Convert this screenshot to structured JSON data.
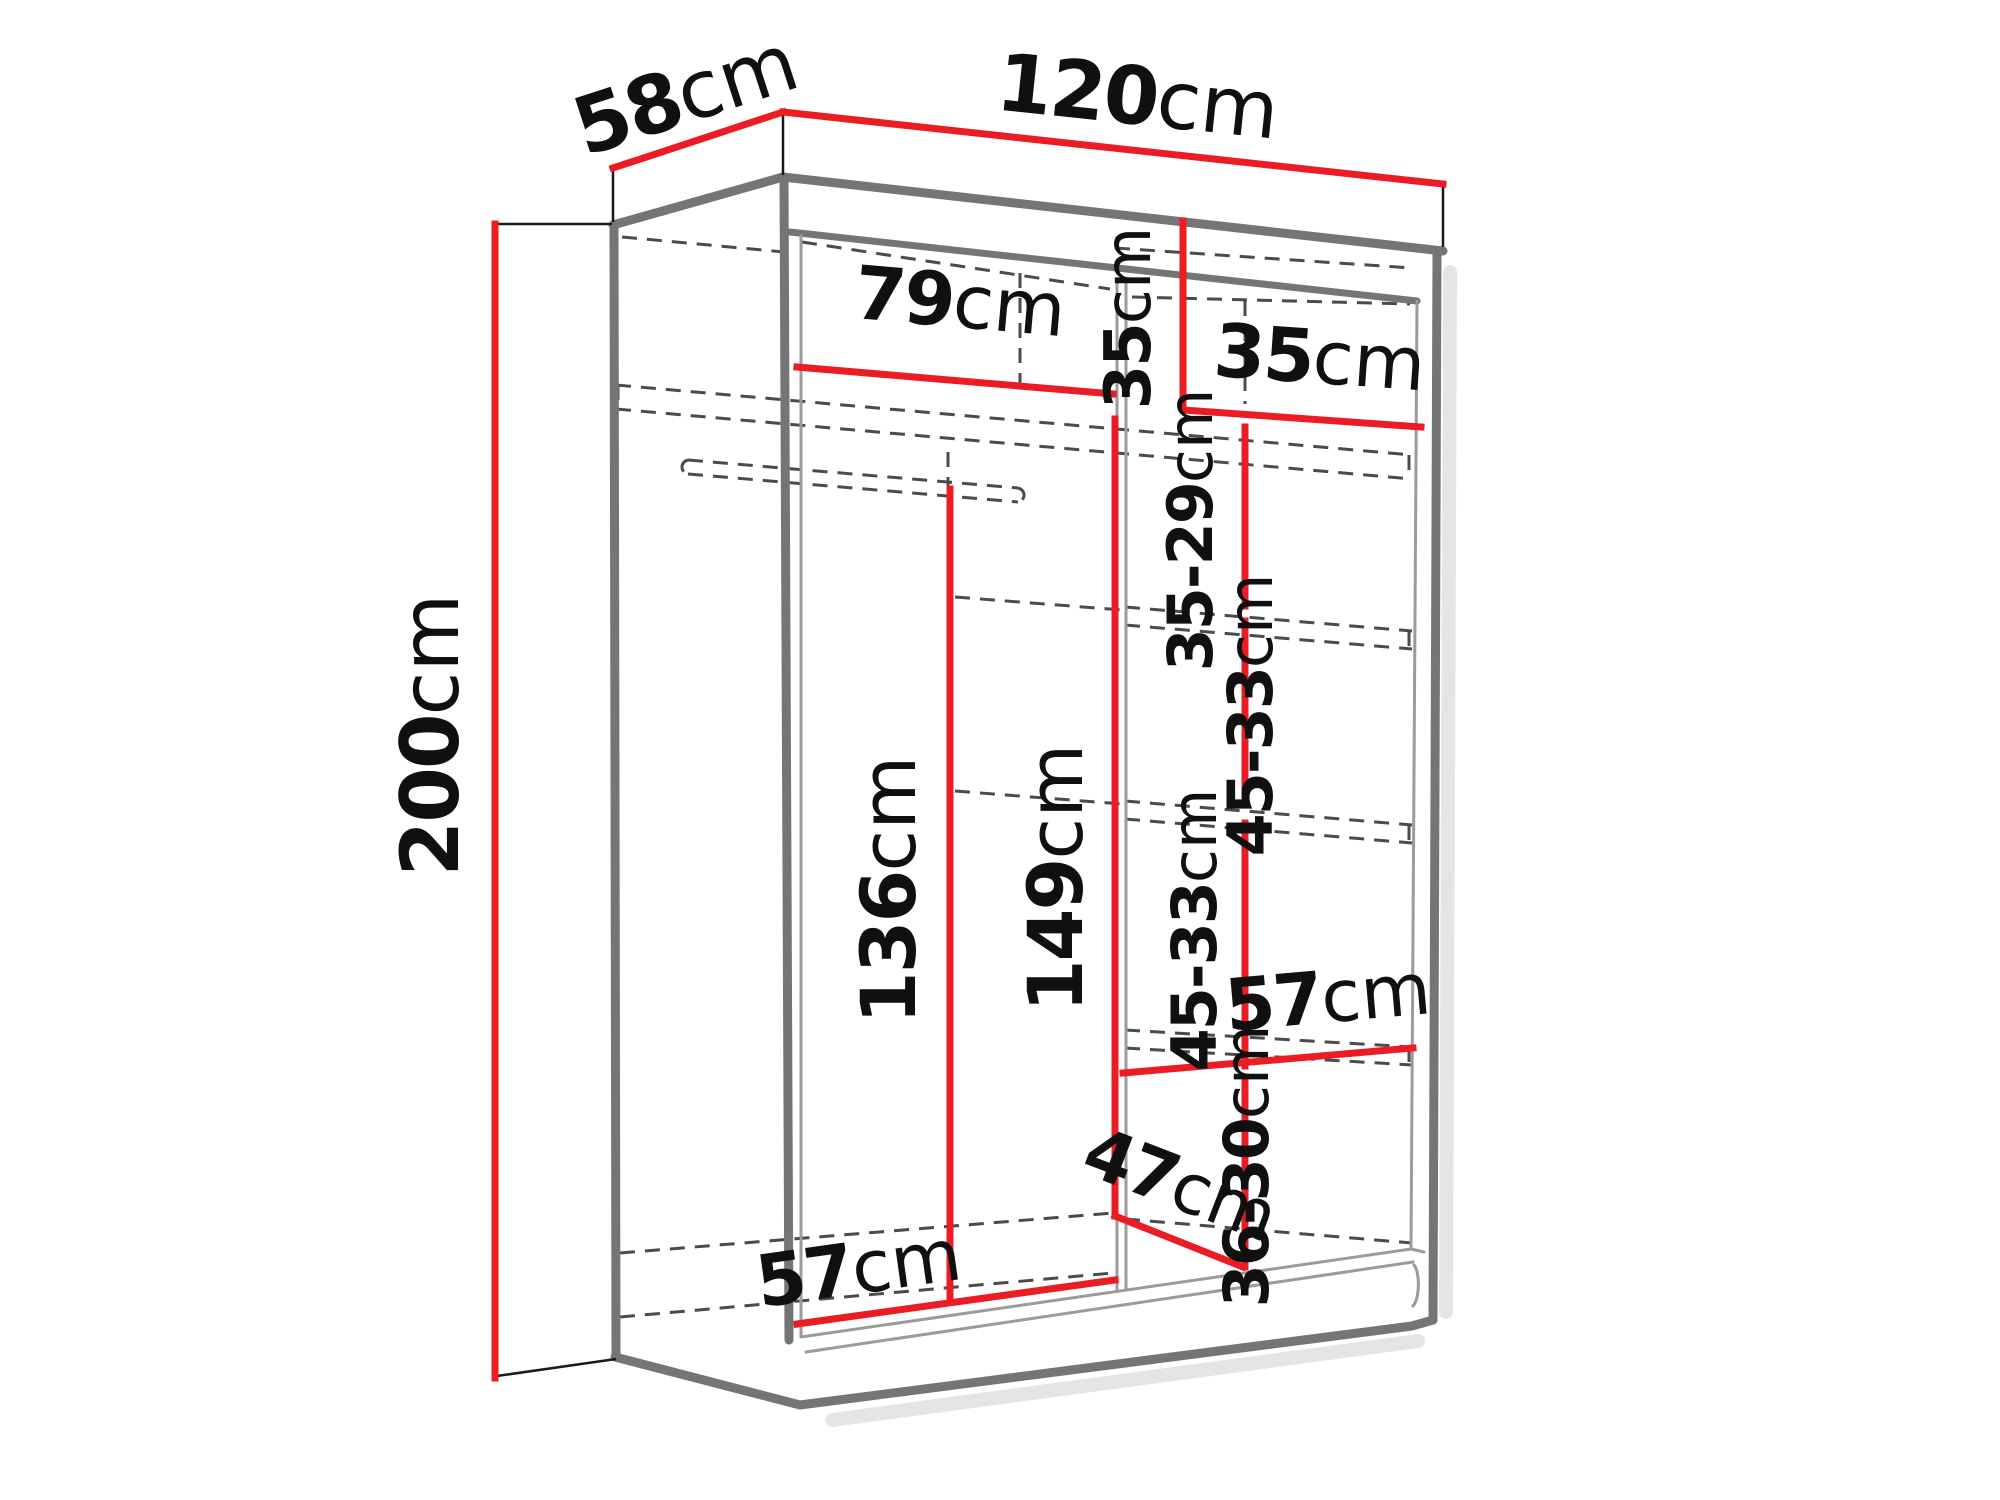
{
  "diagram": {
    "title": "Sliding-door wardrobe dimension diagram",
    "unit": "cm",
    "colors": {
      "dimension_line": "#ec1c24",
      "outline": "#757575",
      "outline_thin": "#9b9b9b",
      "hidden_line": "#4b4b4b",
      "label_text": "#101010",
      "background": "#ffffff"
    },
    "overall_dimensions": {
      "width_cm": "120",
      "depth_cm": "58",
      "height_cm": "200"
    },
    "labels": [
      {
        "id": "depth-58",
        "value": "58",
        "unit": "cm",
        "x": 694,
        "y": 121,
        "rot": -18,
        "size": 80
      },
      {
        "id": "width-120",
        "value": "120",
        "unit": "cm",
        "x": 1135,
        "y": 124,
        "rot": 6,
        "size": 80
      },
      {
        "id": "height-200",
        "value": "200",
        "unit": "cm",
        "x": 458,
        "y": 735,
        "rot": -90,
        "size": 80
      },
      {
        "id": "inner-width-79",
        "value": "79",
        "unit": "cm",
        "x": 958,
        "y": 327,
        "rot": 5,
        "size": 74
      },
      {
        "id": "top-shelf-height-35",
        "value": "35",
        "unit": "cm",
        "x": 1150,
        "y": 318,
        "rot": -90,
        "size": 64
      },
      {
        "id": "top-shelf-width-35",
        "value": "35",
        "unit": "cm",
        "x": 1318,
        "y": 383,
        "rot": 4,
        "size": 74
      },
      {
        "id": "shelf-gap-35-29",
        "value": "35-29",
        "unit": "cm",
        "x": 1212,
        "y": 530,
        "rot": -90,
        "size": 62
      },
      {
        "id": "shelf-gap-45-33-a",
        "value": "45-33",
        "unit": "cm",
        "x": 1272,
        "y": 715,
        "rot": -90,
        "size": 62
      },
      {
        "id": "shelf-gap-45-33-b",
        "value": "45-33",
        "unit": "cm",
        "x": 1216,
        "y": 930,
        "rot": -90,
        "size": 62
      },
      {
        "id": "shelf-depth-57",
        "value": "57",
        "unit": "cm",
        "x": 1330,
        "y": 1022,
        "rot": -5,
        "size": 72
      },
      {
        "id": "shelf-gap-36-30",
        "value": "36-30",
        "unit": "cm",
        "x": 1268,
        "y": 1166,
        "rot": -90,
        "size": 62
      },
      {
        "id": "bottom-depth-47",
        "value": "47",
        "unit": "cm",
        "x": 1172,
        "y": 1207,
        "rot": 21,
        "size": 70
      },
      {
        "id": "hanging-height-136",
        "value": "136",
        "unit": "cm",
        "x": 915,
        "y": 890,
        "rot": -90,
        "size": 76
      },
      {
        "id": "section-height-149",
        "value": "149",
        "unit": "cm",
        "x": 1082,
        "y": 878,
        "rot": -90,
        "size": 76
      },
      {
        "id": "bottom-width-57",
        "value": "57",
        "unit": "cm",
        "x": 862,
        "y": 1293,
        "rot": -8,
        "size": 72
      }
    ]
  }
}
